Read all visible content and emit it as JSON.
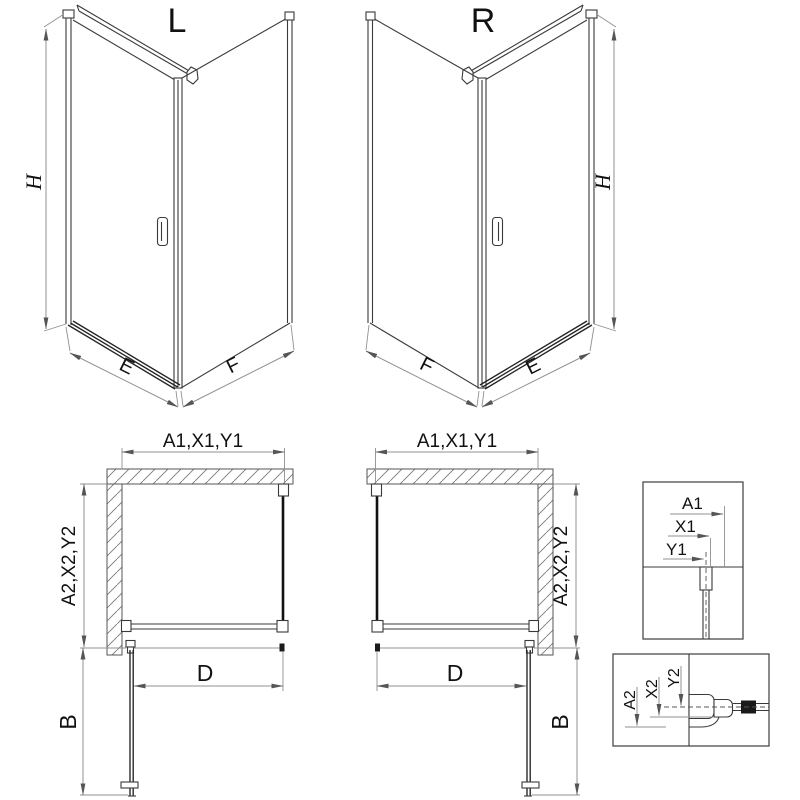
{
  "diagram": {
    "iso_left": {
      "title": "L",
      "dim_height": "H",
      "dim_front": "E",
      "dim_side": "F"
    },
    "iso_right": {
      "title": "R",
      "dim_height": "H",
      "dim_front": "E",
      "dim_side": "F"
    },
    "plan_left": {
      "dim_top": "A1,X1,Y1",
      "dim_side": "A2,X2,Y2",
      "dim_door": "D",
      "dim_swing": "B"
    },
    "plan_right": {
      "dim_top": "A1,X1,Y1",
      "dim_side": "A2,X2,Y2",
      "dim_door": "D",
      "dim_swing": "B"
    },
    "detail_top": {
      "dim_outer": "A1",
      "dim_mid": "X1",
      "dim_center": "Y1"
    },
    "detail_bottom": {
      "dim_outer": "A2",
      "dim_mid": "X2",
      "dim_center": "Y2"
    },
    "colors": {
      "outline": "#3a3a3a",
      "glass": "#111111",
      "dim_line": "#909090",
      "text": "#111111",
      "hatch": "#7a7a7a",
      "background": "#ffffff"
    }
  }
}
